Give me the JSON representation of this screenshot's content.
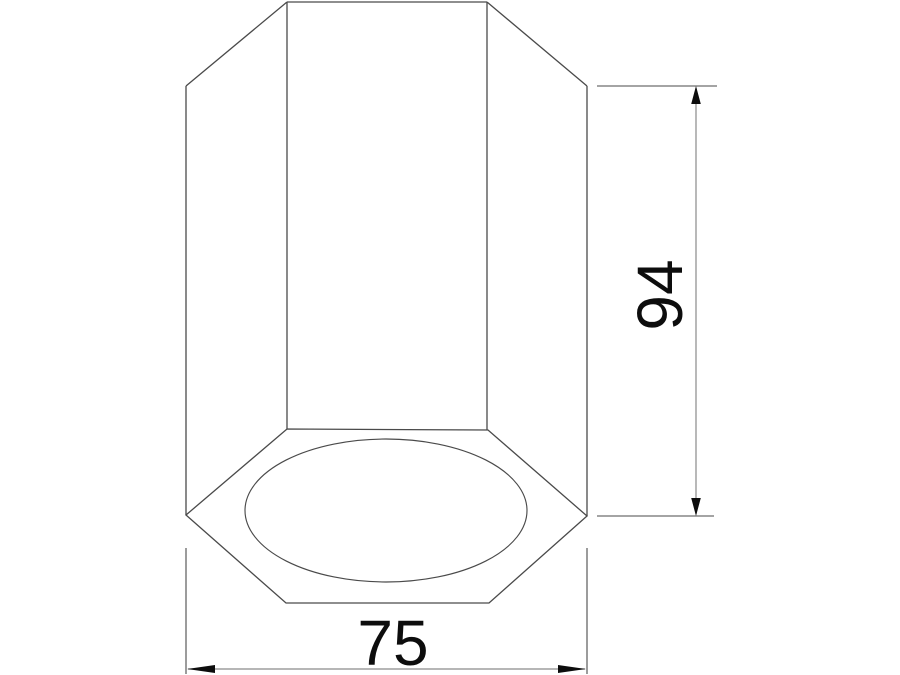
{
  "drawing": {
    "type": "technical-dimension-drawing",
    "subject": "hexagonal-prism-luminaire-bottom-view",
    "dimensions": {
      "height": {
        "value": "94",
        "orientation": "vertical",
        "side": "right"
      },
      "width": {
        "value": "75",
        "orientation": "horizontal",
        "side": "bottom"
      }
    },
    "colors": {
      "background": "#ffffff",
      "outline": "#4a4a4a",
      "dimension_line": "#8a8a8a",
      "text": "#0d0d0d"
    }
  }
}
